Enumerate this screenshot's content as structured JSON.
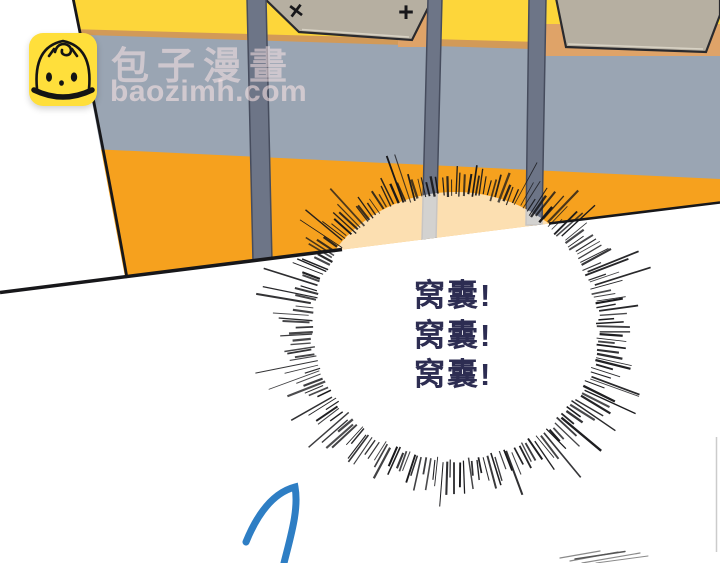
{
  "site_watermark": {
    "name": "包子漫畫",
    "url": "baozimh.com",
    "logo": "baozi-bun-icon"
  },
  "panel": {
    "shout_lines": [
      "窝囊!",
      "窝囊!",
      "窝囊!"
    ]
  },
  "marks": {
    "cross": "×",
    "plus": "+"
  },
  "colors": {
    "yellow": "#fdd63a",
    "orange": "#f6a11e",
    "wall": "#9aa5b3",
    "tan-strip": "#d29a58",
    "tan-back": "#dfa368",
    "panel-top": "#b6afa1",
    "panel-top-edge": "#d8d2c4",
    "outline": "#2a2a2e",
    "post": "#6d7587",
    "post-edge": "#464c5d",
    "ink": "#17171a",
    "glow": "#fffaf0",
    "shout": "#2d2d52",
    "blue": "#2e7ec4",
    "logo-yellow": "#ffdf3b",
    "wm-text": "#ffe7e7",
    "faint-line": "#cccccc",
    "hatch": "#8a8a8a"
  }
}
